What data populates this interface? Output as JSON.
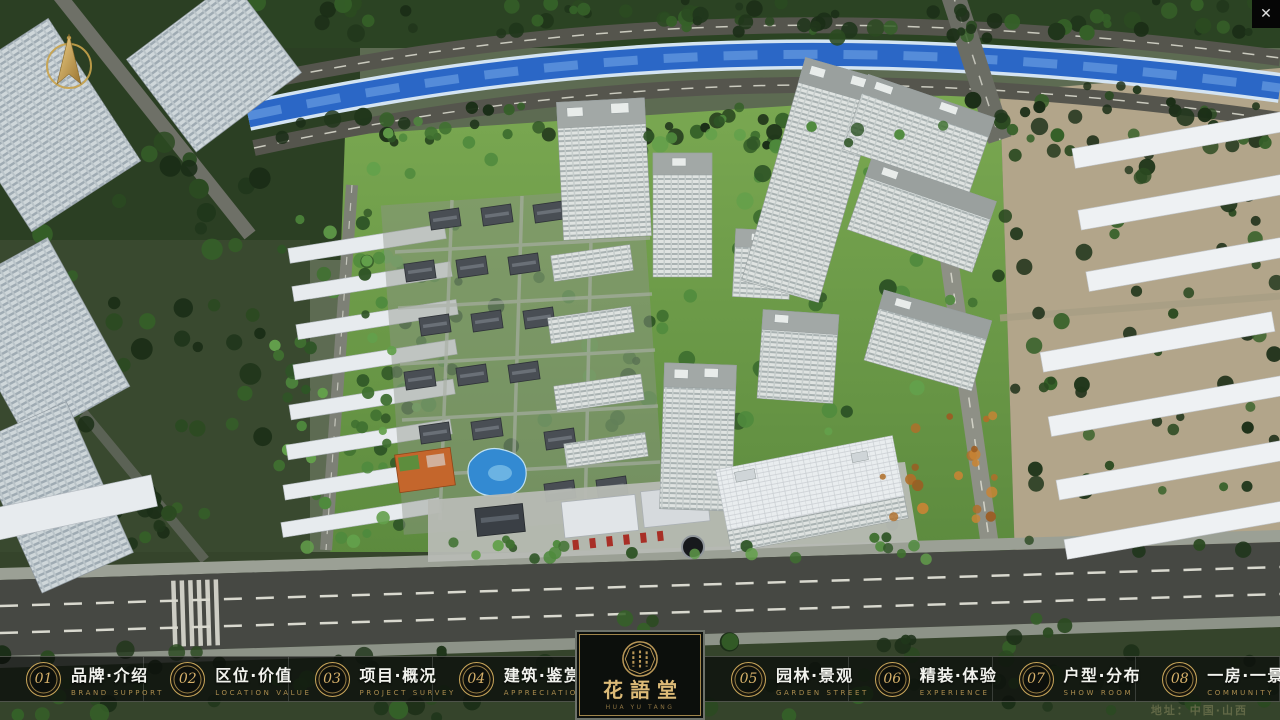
{
  "window": {
    "close_glyph": "✕"
  },
  "logo": {
    "title": "花語堂",
    "subtitle": "HUA YU TANG"
  },
  "footer": {
    "address": "地址：中国·山西"
  },
  "menu": {
    "left_items": [
      {
        "num": "01",
        "zh": "品牌·介绍",
        "en": "BRAND SUPPORT"
      },
      {
        "num": "02",
        "zh": "区位·价值",
        "en": "LOCATION VALUE"
      },
      {
        "num": "03",
        "zh": "项目·概况",
        "en": "PROJECT SURVEY"
      },
      {
        "num": "04",
        "zh": "建筑·鉴赏",
        "en": "APPRECIATION"
      }
    ],
    "right_items": [
      {
        "num": "05",
        "zh": "园林·景观",
        "en": "GARDEN STREET"
      },
      {
        "num": "06",
        "zh": "精装·体验",
        "en": "EXPERIENCE"
      },
      {
        "num": "07",
        "zh": "户型·分布",
        "en": "SHOW ROOM"
      },
      {
        "num": "08",
        "zh": "一房·一景",
        "en": "COMMUNITY"
      }
    ]
  },
  "colors": {
    "accent_gold": "#c9a65a",
    "menu_bar_bg": "rgba(12,14,11,0.78)",
    "menu_text": "#f2f3ee",
    "menu_en_text": "#aa8c4e",
    "river_blue": "#2b67c6",
    "lawn_green": "#6a9d4a",
    "east_ground_tan": "#b2a58a"
  },
  "scene": {
    "seed": 7,
    "tree_palettes": {
      "dark": [
        "#20361b",
        "#2b4a21",
        "#356028",
        "#1b2e17"
      ],
      "mid": [
        "#2f5526",
        "#3f7030",
        "#4f8a3d",
        "#63a04b"
      ],
      "orange": [
        "#b06f2a",
        "#c98434",
        "#9c5d22"
      ]
    },
    "tree_clusters": [
      {
        "layer": "under",
        "x": 245,
        "y": 0,
        "w": 1035,
        "h": 38,
        "n": 80,
        "rmin": 4,
        "rmax": 9,
        "pal": "dark"
      },
      {
        "layer": "under",
        "x": 255,
        "y": 106,
        "w": 720,
        "h": 42,
        "n": 44,
        "rmin": 4,
        "rmax": 9,
        "pal": "dark"
      },
      {
        "layer": "under",
        "x": 955,
        "y": 82,
        "w": 325,
        "h": 70,
        "n": 34,
        "rmin": 4,
        "rmax": 9,
        "pal": "dark"
      },
      {
        "layer": "under",
        "x": 0,
        "y": 118,
        "w": 265,
        "h": 420,
        "n": 60,
        "rmin": 5,
        "rmax": 11,
        "pal": "dark"
      },
      {
        "layer": "under",
        "x": 270,
        "y": 215,
        "w": 190,
        "h": 325,
        "n": 42,
        "rmin": 4,
        "rmax": 8,
        "pal": "mid"
      },
      {
        "layer": "under",
        "x": 378,
        "y": 132,
        "w": 595,
        "h": 395,
        "n": 92,
        "rmin": 4,
        "rmax": 9,
        "pal": "mid"
      },
      {
        "layer": "under",
        "x": 995,
        "y": 112,
        "w": 285,
        "h": 445,
        "n": 66,
        "rmin": 4,
        "rmax": 9,
        "pal": "dark"
      },
      {
        "layer": "under",
        "x": 0,
        "y": 648,
        "w": 640,
        "h": 70,
        "n": 44,
        "rmin": 5,
        "rmax": 10,
        "pal": "dark"
      },
      {
        "layer": "under",
        "x": 620,
        "y": 616,
        "w": 660,
        "h": 100,
        "n": 52,
        "rmin": 5,
        "rmax": 10,
        "pal": "dark"
      },
      {
        "layer": "under",
        "x": 0,
        "y": 492,
        "w": 178,
        "h": 58,
        "n": 22,
        "rmin": 5,
        "rmax": 9,
        "pal": "dark"
      },
      {
        "layer": "over",
        "x": 200,
        "y": 536,
        "w": 730,
        "h": 26,
        "n": 26,
        "rmin": 4,
        "rmax": 7,
        "pal": "mid"
      },
      {
        "layer": "over",
        "x": 380,
        "y": 118,
        "w": 575,
        "h": 26,
        "n": 20,
        "rmin": 4,
        "rmax": 7,
        "pal": "mid"
      },
      {
        "layer": "over",
        "x": 362,
        "y": 150,
        "w": 30,
        "h": 390,
        "n": 18,
        "rmin": 4,
        "rmax": 7,
        "pal": "mid"
      },
      {
        "layer": "over",
        "x": 882,
        "y": 415,
        "w": 115,
        "h": 115,
        "n": 20,
        "rmin": 3,
        "rmax": 6,
        "pal": "orange"
      }
    ],
    "courtyard_houses": [
      [
        430,
        210
      ],
      [
        482,
        206
      ],
      [
        534,
        203
      ],
      [
        405,
        262
      ],
      [
        457,
        258
      ],
      [
        509,
        255
      ],
      [
        420,
        316
      ],
      [
        472,
        312
      ],
      [
        524,
        309
      ],
      [
        405,
        370
      ],
      [
        457,
        366
      ],
      [
        509,
        363
      ],
      [
        420,
        424
      ],
      [
        472,
        420
      ],
      [
        545,
        430
      ],
      [
        545,
        482
      ],
      [
        597,
        478
      ]
    ]
  }
}
